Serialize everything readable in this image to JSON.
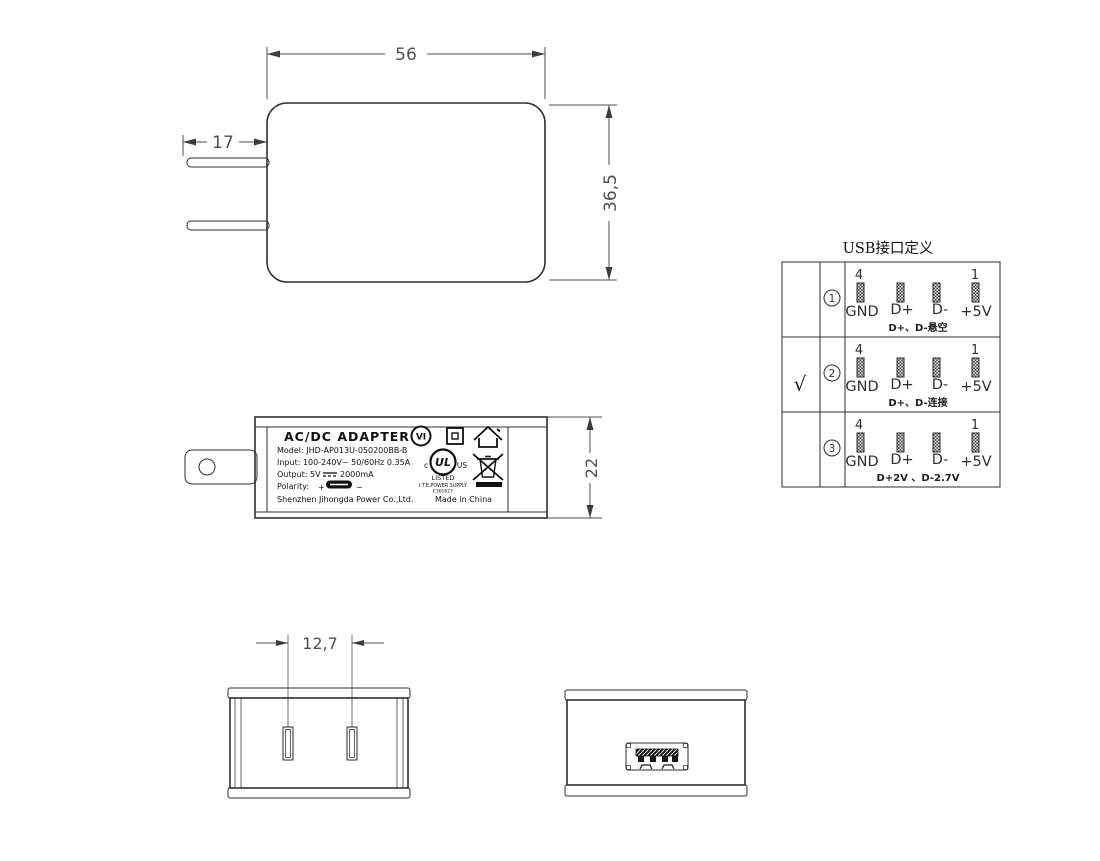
{
  "drawing": {
    "front_view": {
      "width_dim": "56",
      "height_dim": "36,5",
      "prong_length_dim": "17"
    },
    "side_view": {
      "height_dim": "22",
      "label": {
        "title": "AC/DC  ADAPTER",
        "model_line": "Model: JHD-AP013U-050200BB-B",
        "input_line": "Input: 100-240V~  50/60Hz  0.35A",
        "output_prefix": "Output: 5V",
        "output_current": "2000mA",
        "polarity_label": "Polarity:",
        "polarity_plus": "+",
        "polarity_minus": "−",
        "company": "Shenzhen Jihongda Power Co.,Ltd.",
        "made_in": "Made in China",
        "efficiency_mark": "VI",
        "ul_mark": "UL",
        "ul_c": "c",
        "ul_us": "US",
        "ul_listed": "LISTED",
        "ul_supply": "I.T.E.POWER SUPPLY",
        "ul_file": "E361627"
      },
      "icons": [
        "efficiency-vi-icon",
        "class2-double-insulation-icon",
        "indoor-use-house-icon",
        "cul-us-listed-icon",
        "weee-crossed-bin-icon",
        "dc-symbol-icon",
        "usb-polarity-icon"
      ]
    },
    "bottom_view": {
      "prong_spacing_dim": "12,7"
    },
    "usb_table": {
      "title": "USB接口定义",
      "pin_number_left": "4",
      "pin_number_right": "1",
      "pin_labels": [
        "GND",
        "D+",
        "D-",
        "+5V"
      ],
      "rows": [
        {
          "selected": "",
          "num": "1",
          "note": "D+、D-悬空"
        },
        {
          "selected": "√",
          "num": "2",
          "note": "D+、D-连接"
        },
        {
          "selected": "",
          "num": "3",
          "note": "D+2V 、D-2.7V"
        }
      ]
    }
  }
}
